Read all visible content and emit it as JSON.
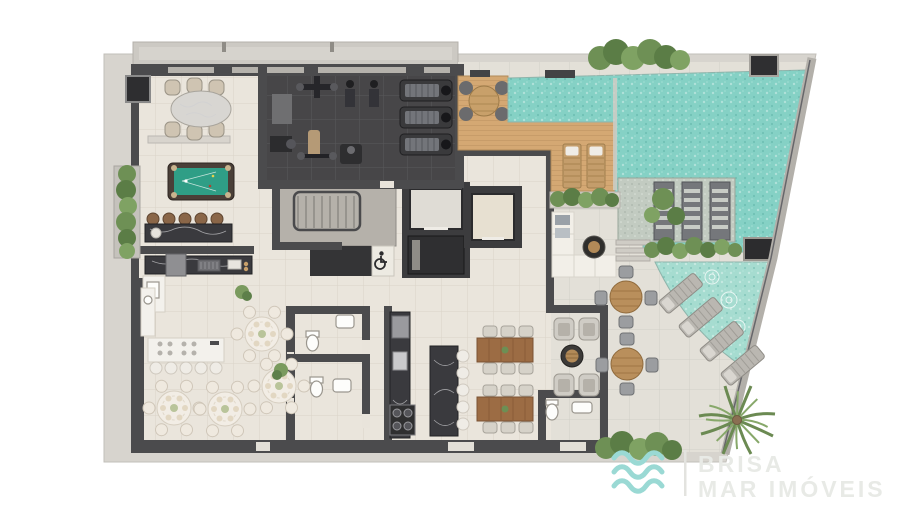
{
  "branding": {
    "icon": "waves-icon",
    "name_line1": "BRISA",
    "name_line2": "MAR IMÓVEIS"
  },
  "icons": {
    "accessibility": "wheelchair-icon"
  },
  "colors": {
    "outer_band": "#D7D4CE",
    "floor_indoor": "#EAE5DC",
    "floor_terrace": "#E3E0D8",
    "wall": "#4B4B4D",
    "gym_floor": "#474648",
    "pool_water": "#85D1C5",
    "pool_water_shallow": "#A6DCD0",
    "deck_wood": "#D4A873",
    "stone_platform": "#C2CBC1",
    "billiard_felt": "#2F9E86",
    "marble_dark": "#3A3A3E",
    "marble_white": "#F3F1EC",
    "wood_table": "#9C6C44",
    "greenery": "#6E9055",
    "logo_wave": "#9AD9D4",
    "logo_text": "#E8EAE6"
  }
}
